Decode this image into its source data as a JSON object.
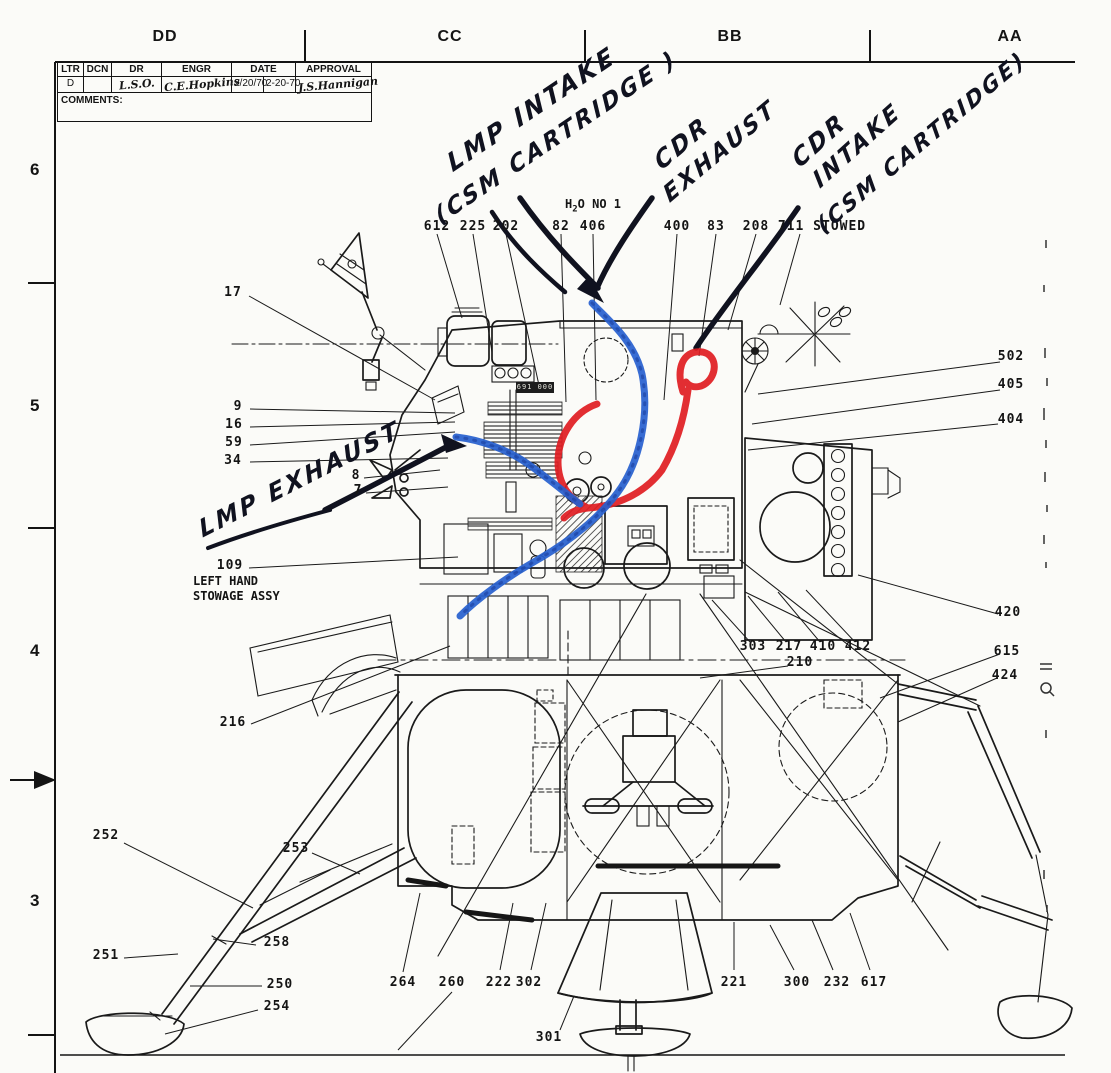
{
  "grid": {
    "top_labels": [
      {
        "t": "DD",
        "x": 165
      },
      {
        "t": "CC",
        "x": 450
      },
      {
        "t": "BB",
        "x": 730
      },
      {
        "t": "AA",
        "x": 1010
      }
    ],
    "left_labels": [
      {
        "t": "6",
        "y": 160
      },
      {
        "t": "5",
        "y": 396
      },
      {
        "t": "4",
        "y": 641
      },
      {
        "t": "3",
        "y": 891
      }
    ]
  },
  "title_block": {
    "headers": [
      "LTR",
      "DCN",
      "DR",
      "ENGR",
      "DATE",
      "APPROVAL"
    ],
    "values": {
      "ltr": "D",
      "dcn": "",
      "dr": "L.S.O.",
      "engr": "C.E.Hopkins",
      "date_a": "2/20/70",
      "date_b": "2-20-70",
      "approval": "J.S.Hannigan"
    },
    "comments_label": "COMMENTS:"
  },
  "water_label": {
    "pre": "H",
    "sub": "2",
    "post": "O NO 1"
  },
  "stowage_label": {
    "line1": "LEFT HAND",
    "line2": "STOWAGE ASSY"
  },
  "chip_label": "691 000",
  "colors": {
    "marker_red": "#e01d22",
    "marker_blue": "#2760cf",
    "ink": "#141414"
  },
  "handwriting": {
    "items": [
      {
        "text": "LMP  INTAKE",
        "x": 449,
        "y": 150,
        "rot": -34,
        "size": 25
      },
      {
        "text": "(CSM CARTRIDGE )",
        "x": 437,
        "y": 205,
        "rot": -34,
        "size": 23
      },
      {
        "text": "CDR",
        "x": 657,
        "y": 150,
        "rot": -40,
        "size": 24
      },
      {
        "text": "EXHAUST",
        "x": 666,
        "y": 184,
        "rot": -40,
        "size": 23
      },
      {
        "text": "CDR",
        "x": 795,
        "y": 148,
        "rot": -42,
        "size": 24
      },
      {
        "text": "INTAKE",
        "x": 816,
        "y": 170,
        "rot": -42,
        "size": 23
      },
      {
        "text": "(CSM CARTRIDGE)",
        "x": 820,
        "y": 216,
        "rot": -40,
        "size": 22
      },
      {
        "text": "LMP EXHAUST",
        "x": 200,
        "y": 516,
        "rot": -27,
        "size": 24
      }
    ]
  },
  "callouts": [
    {
      "t": "612",
      "x": 437,
      "y": 219
    },
    {
      "t": "225",
      "x": 473,
      "y": 219
    },
    {
      "t": "202",
      "x": 506,
      "y": 219
    },
    {
      "t": "82",
      "x": 561,
      "y": 219
    },
    {
      "t": "406",
      "x": 593,
      "y": 219
    },
    {
      "t": "400",
      "x": 677,
      "y": 219
    },
    {
      "t": "83",
      "x": 716,
      "y": 219
    },
    {
      "t": "208",
      "x": 756,
      "y": 219
    },
    {
      "t": "711 STOWED",
      "x": 822,
      "y": 219
    },
    {
      "t": "17",
      "x": 233,
      "y": 285
    },
    {
      "t": "9",
      "x": 238,
      "y": 399
    },
    {
      "t": "16",
      "x": 234,
      "y": 417
    },
    {
      "t": "59",
      "x": 234,
      "y": 435
    },
    {
      "t": "34",
      "x": 233,
      "y": 453
    },
    {
      "t": "8",
      "x": 356,
      "y": 468
    },
    {
      "t": "7",
      "x": 358,
      "y": 483
    },
    {
      "t": "109",
      "x": 230,
      "y": 558
    },
    {
      "t": "216",
      "x": 233,
      "y": 715
    },
    {
      "t": "252",
      "x": 106,
      "y": 828
    },
    {
      "t": "253",
      "x": 296,
      "y": 841
    },
    {
      "t": "258",
      "x": 277,
      "y": 935
    },
    {
      "t": "251",
      "x": 106,
      "y": 948
    },
    {
      "t": "250",
      "x": 280,
      "y": 977
    },
    {
      "t": "254",
      "x": 277,
      "y": 999
    },
    {
      "t": "264",
      "x": 403,
      "y": 975
    },
    {
      "t": "260",
      "x": 452,
      "y": 975
    },
    {
      "t": "222",
      "x": 499,
      "y": 975
    },
    {
      "t": "302",
      "x": 529,
      "y": 975
    },
    {
      "t": "301",
      "x": 549,
      "y": 1030
    },
    {
      "t": "221",
      "x": 734,
      "y": 975
    },
    {
      "t": "300",
      "x": 797,
      "y": 975
    },
    {
      "t": "232",
      "x": 837,
      "y": 975
    },
    {
      "t": "617",
      "x": 874,
      "y": 975
    },
    {
      "t": "303",
      "x": 753,
      "y": 639
    },
    {
      "t": "217",
      "x": 789,
      "y": 639
    },
    {
      "t": "410",
      "x": 823,
      "y": 639
    },
    {
      "t": "412",
      "x": 858,
      "y": 639
    },
    {
      "t": "210",
      "x": 800,
      "y": 655
    },
    {
      "t": "502",
      "x": 1011,
      "y": 349
    },
    {
      "t": "405",
      "x": 1011,
      "y": 377
    },
    {
      "t": "404",
      "x": 1011,
      "y": 412
    },
    {
      "t": "420",
      "x": 1008,
      "y": 605
    },
    {
      "t": "615",
      "x": 1007,
      "y": 644
    },
    {
      "t": "424",
      "x": 1005,
      "y": 668
    }
  ]
}
